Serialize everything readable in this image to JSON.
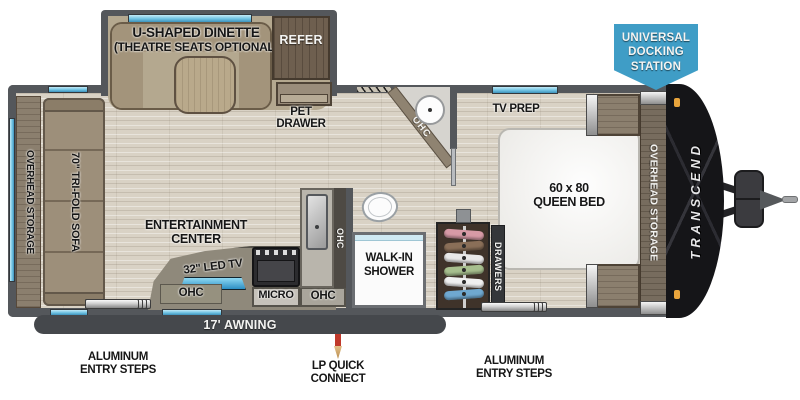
{
  "title": "Travel trailer floor plan",
  "banner": {
    "line1": "UNIVERSAL",
    "line2": "DOCKING",
    "line3": "STATION"
  },
  "labels": {
    "dinette1": "U-SHAPED DINETTE",
    "dinette2": "(THEATRE SEATS OPTIONAL)",
    "refer": "REFER",
    "pet1": "PET",
    "pet2": "DRAWER",
    "overhead_left": "OVERHEAD STORAGE",
    "sofa": "70\" TRI-FOLD SOFA",
    "ent1": "ENTERTAINMENT",
    "ent2": "CENTER",
    "tv": "32\" LED TV",
    "ohc_tv": "OHC",
    "micro": "MICRO",
    "ohc_micro": "OHC",
    "ohc_sink": "OHC",
    "ohc_bath": "OHC",
    "shower1": "WALK-IN",
    "shower2": "SHOWER",
    "tv_prep": "TV PREP",
    "bed1": "60 x 80",
    "bed2": "QUEEN BED",
    "drawers": "DRAWERS",
    "overhead_bed": "OVERHEAD STORAGE",
    "brand": "TRANSCEND",
    "awning": "17' AWNING",
    "steps1": "ALUMINUM",
    "steps2": "ENTRY STEPS",
    "lp1": "LP QUICK",
    "lp2": "CONNECT"
  },
  "colors": {
    "banner_blue": "#3f9dc6",
    "window_blue": "#6fc2e2",
    "wall_gray": "#54575b",
    "floor_tan": "#d9d2c5",
    "cap_black": "#151518",
    "marker_orange": "#e8a43c",
    "lp_red": "#c0392b"
  },
  "hanger_colors": [
    "#d79aa6",
    "#8a6f58",
    "#e9e9e9",
    "#a7bf8e",
    "#f0f0f0",
    "#6fa8d0"
  ]
}
